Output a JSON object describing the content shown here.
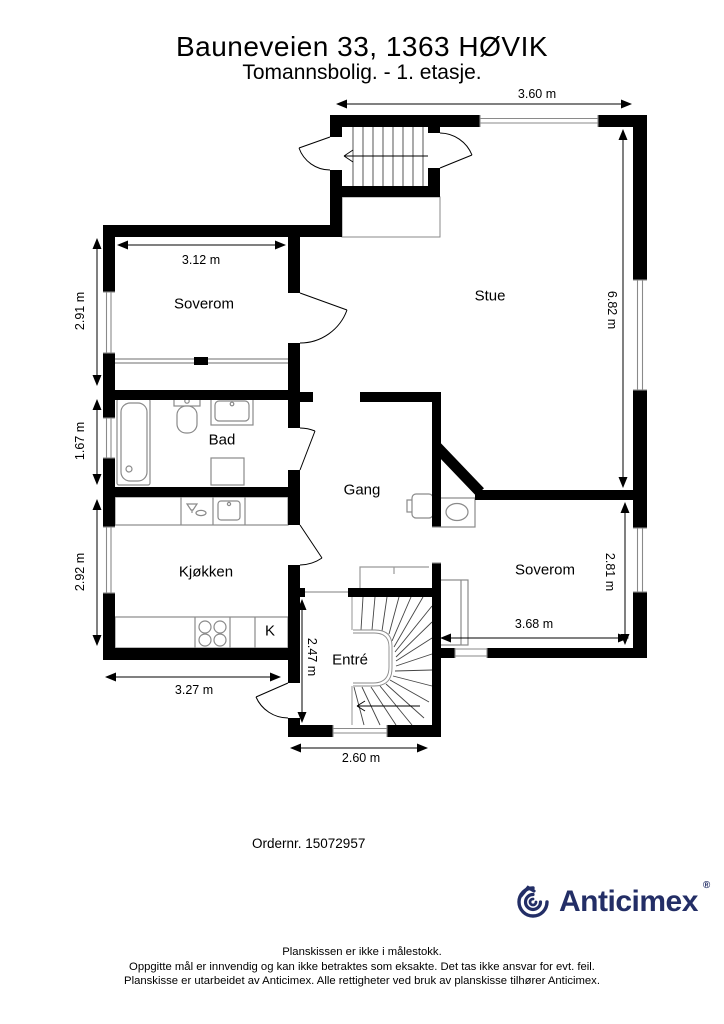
{
  "header": {
    "title": "Bauneveien 33, 1363 HØVIK",
    "subtitle": "Tomannsbolig.  - 1. etasje."
  },
  "rooms": {
    "soverom1": "Soverom",
    "stue": "Stue",
    "bad": "Bad",
    "gang": "Gang",
    "kjokken": "Kjøkken",
    "entre": "Entré",
    "soverom2": "Soverom",
    "fridge": "K"
  },
  "dims": {
    "top_width": "3.60 m",
    "soverom1_width": "3.12 m",
    "soverom1_height": "2.91 m",
    "bad_height": "1.67 m",
    "kjokken_height": "2.92 m",
    "kjokken_width": "3.27 m",
    "stue_height": "6.82 m",
    "soverom2_height": "2.81 m",
    "soverom2_width": "3.68 m",
    "entre_height": "2.47 m",
    "entre_width": "2.60 m"
  },
  "order_number": "Ordernr. 15072957",
  "logo": {
    "text": "Anticimex",
    "mark": "®"
  },
  "colors": {
    "wall": "#000000",
    "fixture_outline": "#8a8a8a",
    "brand_navy": "#232e66"
  },
  "footer": {
    "line1": "Planskissen er ikke i målestokk.",
    "line2": "Oppgitte mål er innvendig og kan ikke betraktes som eksakte. Det tas ikke ansvar for evt. feil.",
    "line3": "Planskisse er utarbeidet av Anticimex. Alle rettigheter ved bruk av planskisse tilhører Anticimex."
  }
}
